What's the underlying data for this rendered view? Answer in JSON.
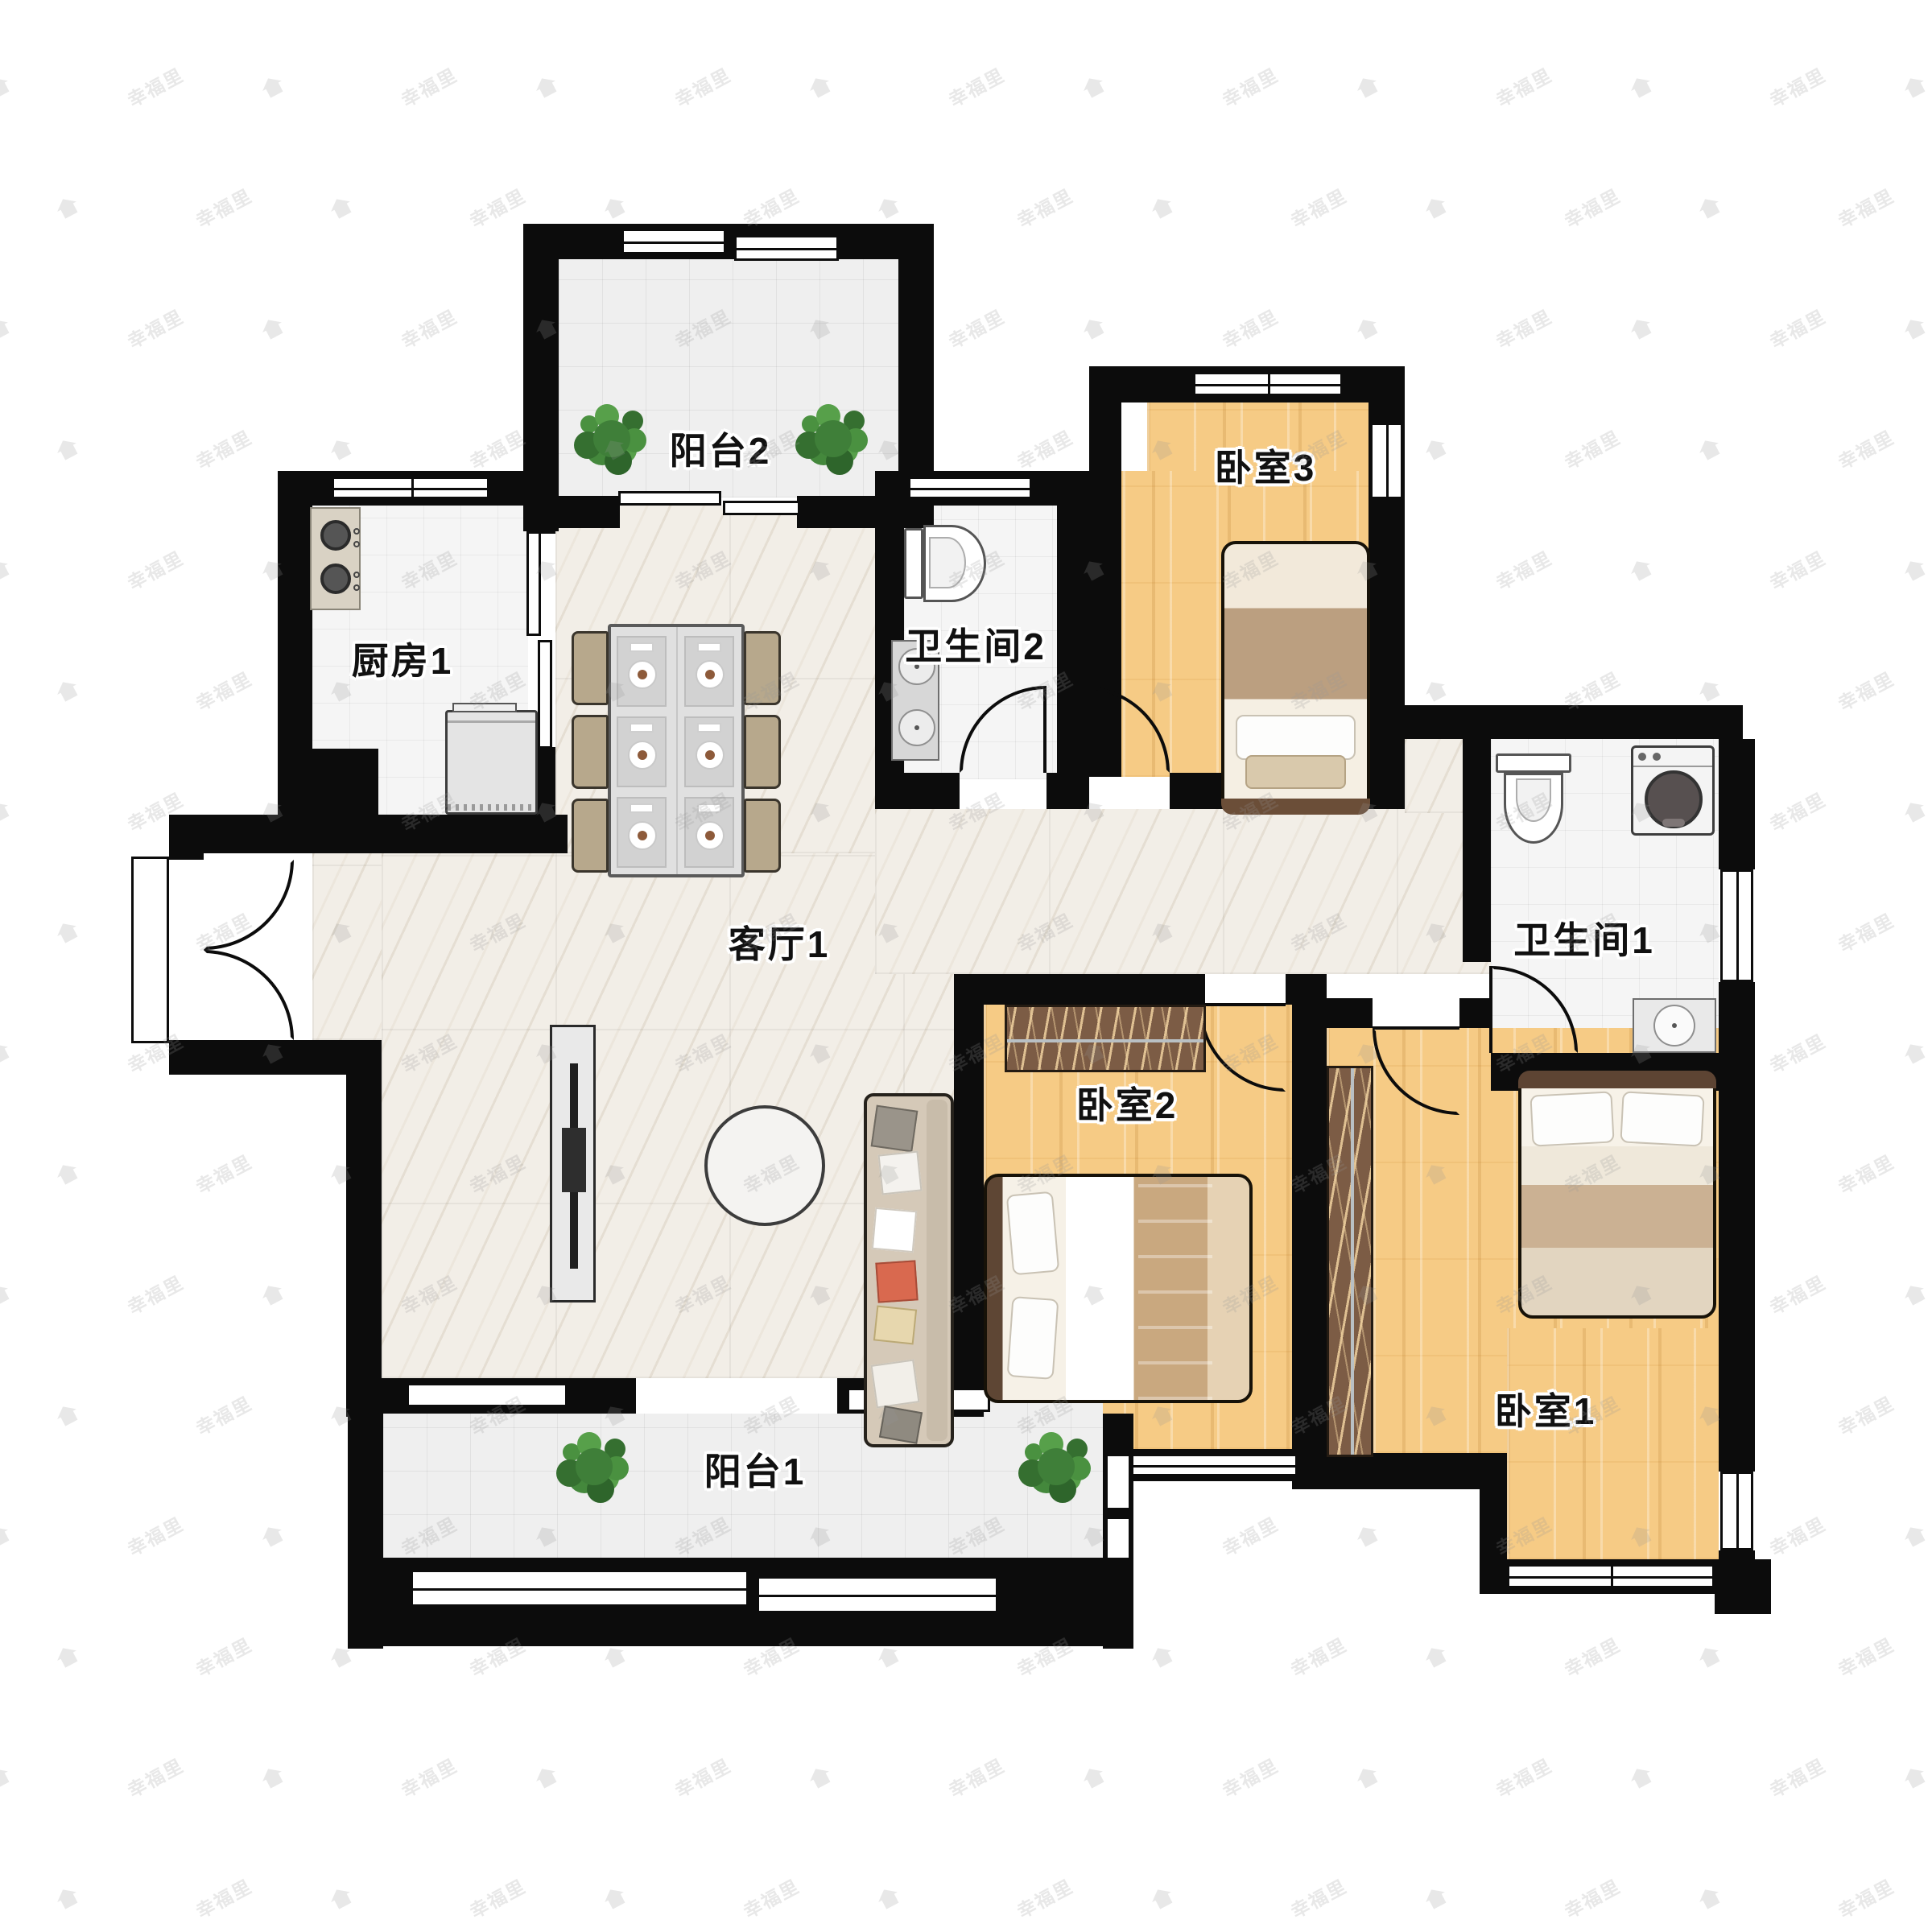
{
  "watermark": {
    "text": "幸福里"
  },
  "rooms": {
    "balcony2": {
      "label": "阳台2"
    },
    "kitchen": {
      "label": "厨房1"
    },
    "bathroom2": {
      "label": "卫生间2"
    },
    "bedroom3": {
      "label": "卧室3"
    },
    "living": {
      "label": "客厅1"
    },
    "bathroom1": {
      "label": "卫生间1"
    },
    "bedroom2": {
      "label": "卧室2"
    },
    "bedroom1": {
      "label": "卧室1"
    },
    "balcony1": {
      "label": "阳台1"
    }
  },
  "colors": {
    "wall": "#0c0c0c",
    "wood_floor": "#f6cb85",
    "marble_floor": "#f2eee7",
    "tile_floor": "#efefef",
    "wardrobe": "#7c5c45",
    "plant": "#3f7f39",
    "label_text": "#111111",
    "watermark": "#ededed"
  }
}
